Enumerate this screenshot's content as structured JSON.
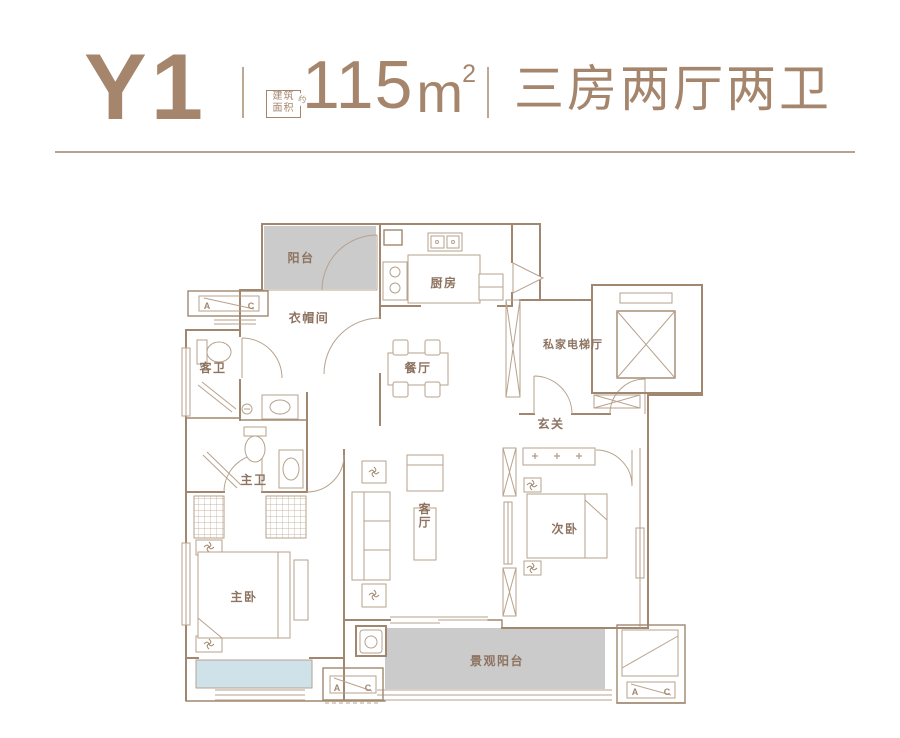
{
  "header": {
    "unit_name": "Y1",
    "area_label_top": "建筑",
    "area_label_bottom": "面积",
    "area_approx": "约",
    "area_value": "115",
    "area_unit": "m",
    "area_exponent": "2",
    "layout_type": "三房两厅两卫"
  },
  "rooms": {
    "balcony": "阳台",
    "cloakroom": "衣帽间",
    "guest_bath": "客卫",
    "kitchen": "厨房",
    "dining": "餐厅",
    "private_elevator_hall": "私家电梯厅",
    "foyer": "玄关",
    "master_bath": "主卫",
    "living_room": "客厅",
    "second_bedroom": "次卧",
    "master_bedroom": "主卧",
    "view_balcony": "景观阳台"
  },
  "plan_marks": {
    "ac_a": "A",
    "ac_c": "C"
  },
  "colors": {
    "accent": "#a5866d",
    "wall": "#a1876f",
    "thin_line": "#b7a28d",
    "label": "#8d7360",
    "balcony_fill": "#cbcbcb",
    "baywindow_fill": "#cfe2ea"
  }
}
